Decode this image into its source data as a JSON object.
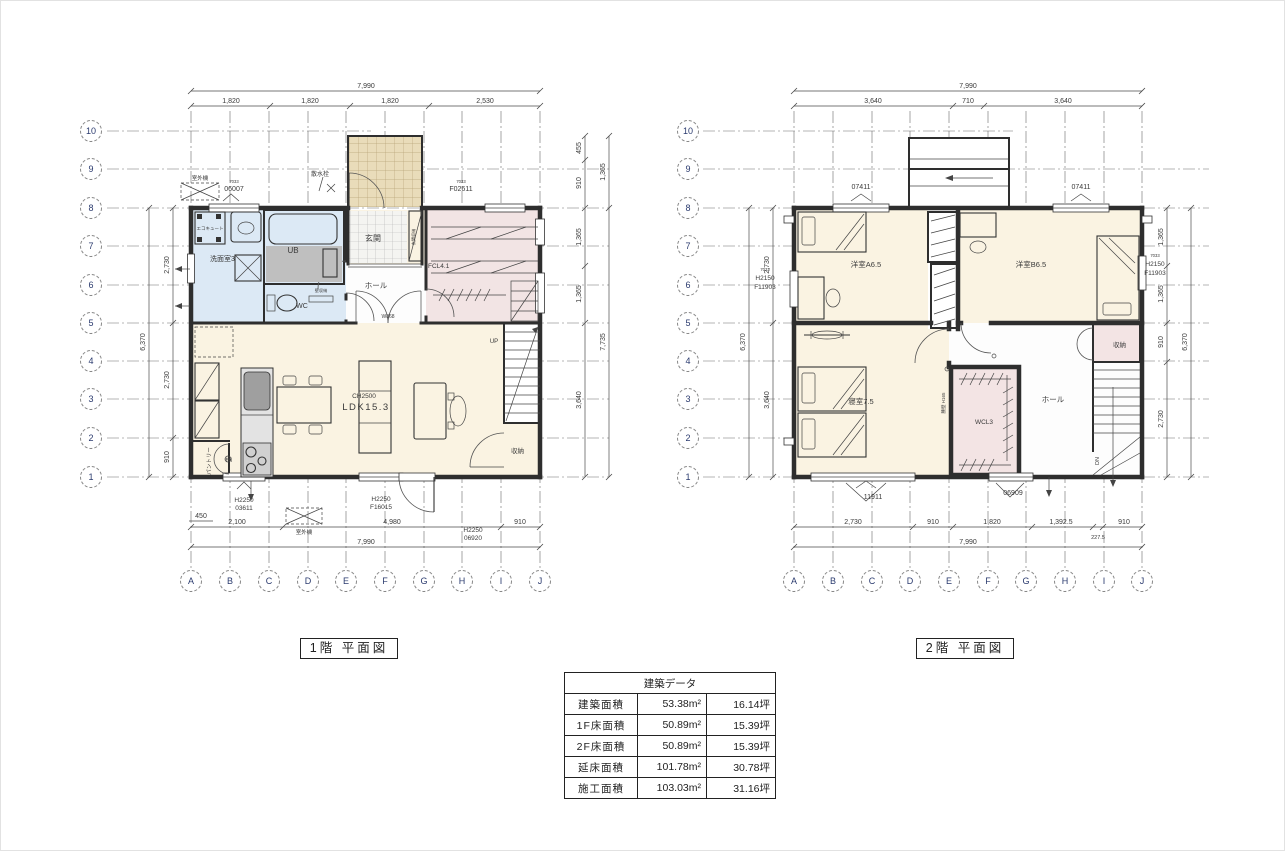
{
  "grid": {
    "rows": [
      "10",
      "9",
      "8",
      "7",
      "6",
      "5",
      "4",
      "3",
      "2",
      "1"
    ],
    "cols": [
      "A",
      "B",
      "C",
      "D",
      "E",
      "F",
      "G",
      "H",
      "I",
      "J"
    ]
  },
  "plan1f": {
    "title": "1階 平面図",
    "dims": {
      "top_total": "7,990",
      "top": [
        "1,820",
        "1,820",
        "1,820",
        "2,530"
      ],
      "bottom": [
        "2,100",
        "4,980",
        "910"
      ],
      "bottom_total": "7,990",
      "bottom_left_small": "450",
      "left": [
        "2,730",
        "2,730",
        "910"
      ],
      "left_total": "6,370",
      "right_upper": [
        "455",
        "910"
      ],
      "right_upper_total": "1,365",
      "right": [
        "1,365",
        "1,365",
        "3,640"
      ],
      "right_total": "7,735"
    },
    "rooms": {
      "genkan": "玄関",
      "ub": "UB",
      "senmen": "洗面室3",
      "wc": "WC",
      "hall": "ホール",
      "fcl": "FCL4.1",
      "ldk_ch": "CH2500",
      "ldk": "LDK15.3",
      "shuno": "収納",
      "pantry": "パントリー",
      "up": "UP"
    },
    "labels": {
      "ecocute": "エコキュート",
      "gaiki_top": "室外機",
      "gaiki_bottom": "室外機",
      "sansui": "散水栓",
      "genkan_shuno": "玄関収納",
      "kabe_shuno": "壁収納",
      "ih": "IH",
      "w868": "W868"
    },
    "windows": {
      "code_top_left_small": "7033",
      "top_left": "06007",
      "code_top_right_small": "7033",
      "top_right": "F02611",
      "bottom_left_1": "H2250",
      "bottom_left_2": "03611",
      "bottom_mid_1": "H2250",
      "bottom_mid_2": "F16015",
      "bottom_right_1": "H2250",
      "bottom_right_2": "06920"
    }
  },
  "plan2f": {
    "title": "2階 平面図",
    "dims": {
      "top_total": "7,990",
      "top": [
        "3,640",
        "710",
        "3,640"
      ],
      "bottom": [
        "2,730",
        "910",
        "1,820",
        "1,392.5",
        "910"
      ],
      "bottom_small": "227.5",
      "bottom_total": "7,990",
      "left": [
        "2,730",
        "3,640"
      ],
      "left_total": "6,370",
      "right": [
        "1,365",
        "1,365",
        "910",
        "2,730"
      ],
      "right_total": "6,370"
    },
    "rooms": {
      "yoshitsu_a": "洋室A6.5",
      "yoshitsu_b": "洋室B6.5",
      "shinshitsu": "寝室7.5",
      "wcl": "WCL3",
      "hall": "ホール",
      "shuno": "収納",
      "dn": "DN"
    },
    "labels": {
      "koshikabe": "腰壁 H165"
    },
    "windows": {
      "top_left": "07411",
      "top_right": "07411",
      "side_code_small": "7033",
      "side_left_1": "H2150",
      "side_left_2": "F11903",
      "side_right_1": "H2150",
      "side_right_2": "F11903",
      "bottom_left": "11911",
      "bottom_right": "06909"
    }
  },
  "data_table": {
    "title": "建築データ",
    "rows": [
      {
        "label": "建築面積",
        "m2": "53.38m²",
        "tsubo": "16.14坪"
      },
      {
        "label": "1F床面積",
        "m2": "50.89m²",
        "tsubo": "15.39坪"
      },
      {
        "label": "2F床面積",
        "m2": "50.89m²",
        "tsubo": "15.39坪"
      },
      {
        "label": "延床面積",
        "m2": "101.78m²",
        "tsubo": "30.78坪"
      },
      {
        "label": "施工面積",
        "m2": "103.03m²",
        "tsubo": "31.16坪"
      }
    ]
  }
}
